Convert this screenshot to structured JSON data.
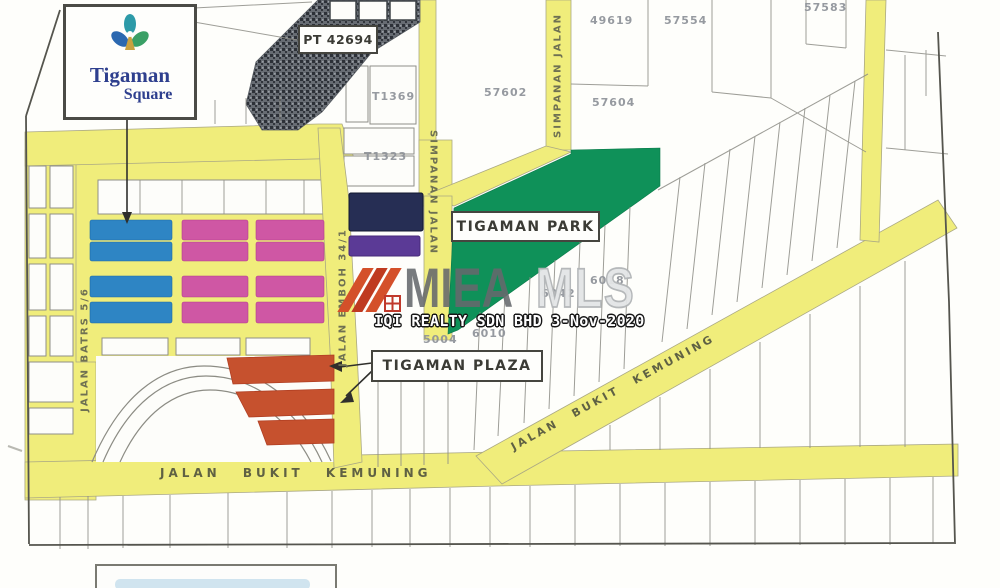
{
  "map": {
    "logo": {
      "line1": "Tigaman",
      "line2": "Square"
    },
    "callouts": {
      "pt_lot": "PT 42694",
      "park": "TIGAMAN PARK",
      "plaza": "TIGAMAN PLAZA"
    },
    "roads": {
      "bottom": "JALAN BUKIT KEMUNING",
      "diagonal": "JALAN BUKIT KEMUNING",
      "simpanan_right": "SIMPANAN JALAN",
      "simpanan_center": "SIMPANAN JALAN",
      "emboh": "JALAN EMBOH 34/1",
      "batrs": "JALAN BATRS 5/6"
    },
    "parcels": {
      "t1369": "T1369",
      "t1323": "T1323",
      "n57602": "57602",
      "n57604": "57604",
      "n49619": "49619",
      "n57554": "57554",
      "n57583": "57583",
      "n6018": "6018",
      "n6042": "6042",
      "n6010": "6010",
      "n5004": "5004"
    },
    "watermark": {
      "brand": "MIEA",
      "suffix": "MLS",
      "caption": "IQI REALTY SDN BHD 3-Nov-2020"
    },
    "colors": {
      "road_yellow": "#f0ed7b",
      "park_green": "#0f9159",
      "block_blue": "#2e85c4",
      "block_pink": "#cf57a4",
      "block_navy": "#262e54",
      "block_purple": "#5b3a96",
      "plaza_orange": "#c6512e",
      "watermark_gray": "#66696d",
      "stripe_red": "#d4502a"
    }
  }
}
